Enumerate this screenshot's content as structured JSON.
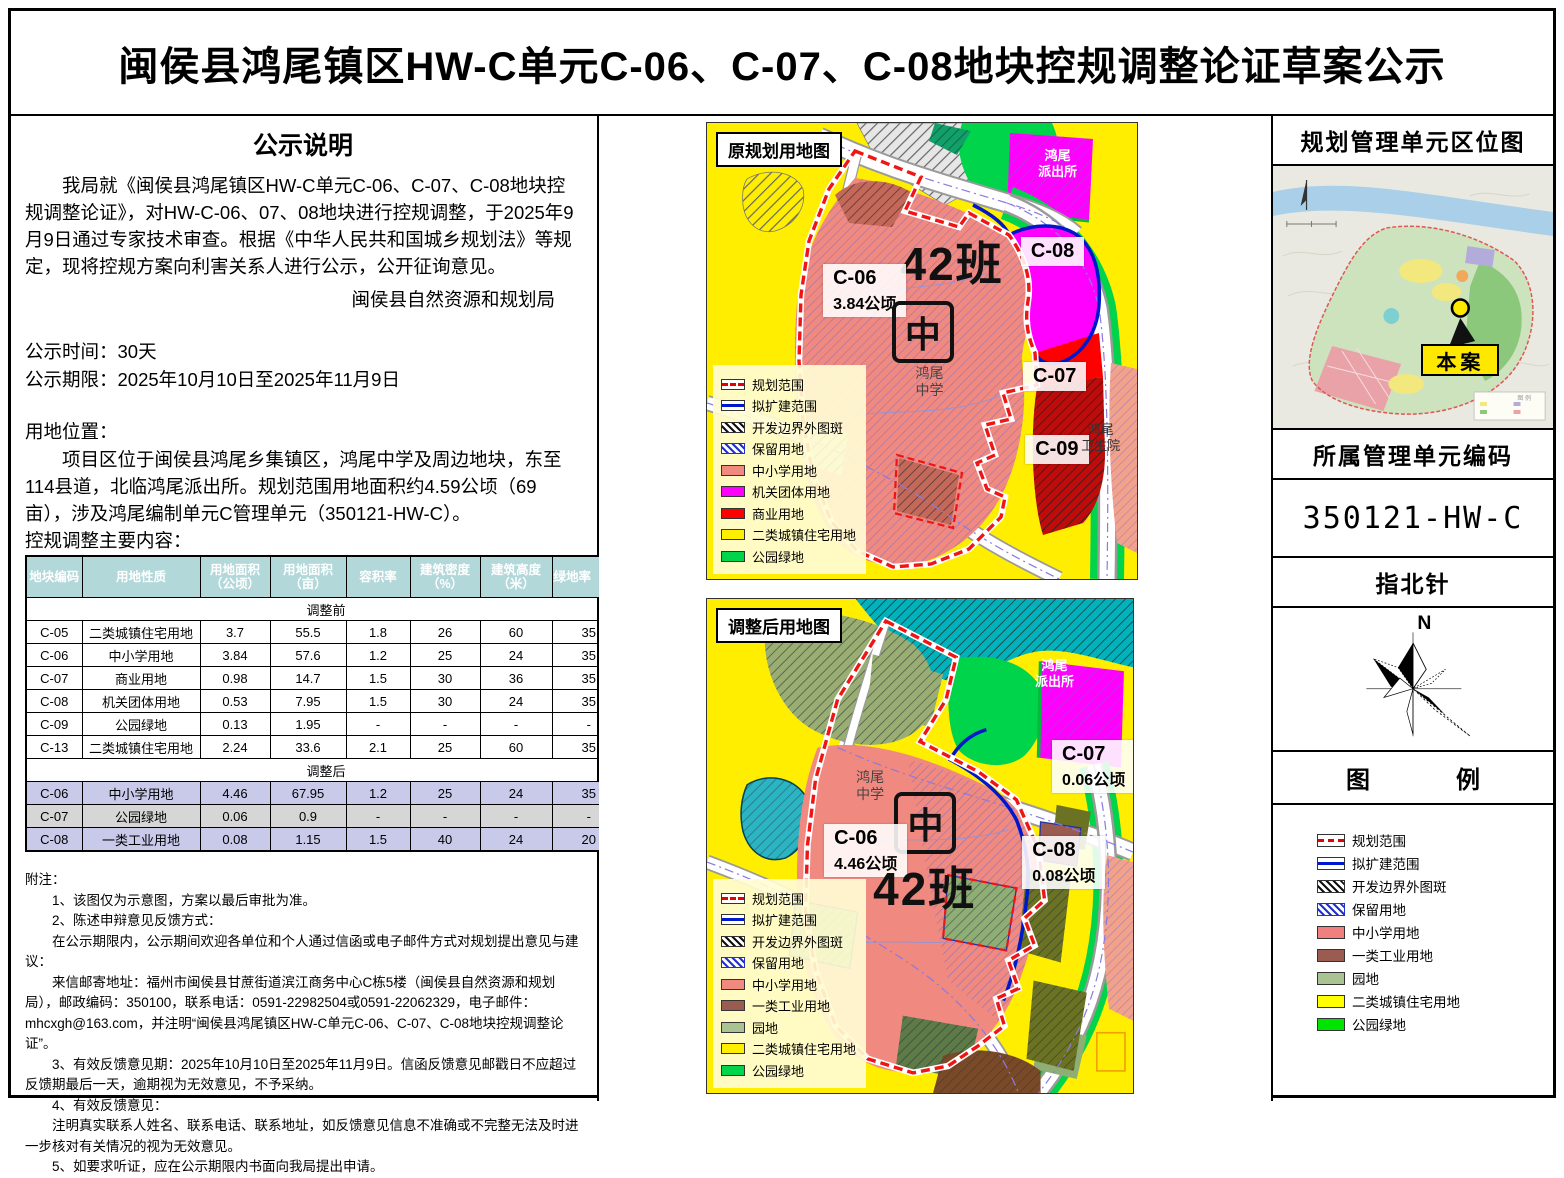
{
  "title": "闽侯县鸿尾镇区HW-C单元C-06、C-07、C-08地块控规调整论证草案公示",
  "left": {
    "announce_heading": "公示说明",
    "announce_body": "我局就《闽侯县鸿尾镇区HW-C单元C-06、C-07、C-08地块控规调整论证》，对HW-C-06、07、08地块进行控规调整，于2025年9月9日通过专家技术审查。根据《中华人民共和国城乡规划法》等规定，现将控规方案向利害关系人进行公示，公开征询意见。",
    "announce_signature": "闽侯县自然资源和规划局",
    "publicity_time": "公示时间：30天",
    "publicity_period": "公示期限：2025年10月10日至2025年11月9日",
    "location_heading": "用地位置：",
    "location_body": "项目区位于闽侯县鸿尾乡集镇区，鸿尾中学及周边地块，东至114县道，北临鸿尾派出所。规划范围用地面积约4.59公顷（69亩），涉及鸿尾编制单元C管理单元（350121-HW-C）。",
    "table_heading": "控规调整主要内容：",
    "notes": [
      "附注：",
      "1、该图仅为示意图，方案以最后审批为准。",
      "2、陈述申辩意见反馈方式：",
      "在公示期限内，公示期间欢迎各单位和个人通过信函或电子邮件方式对规划提出意见与建议：",
      "来信邮寄地址：福州市闽侯县甘蔗街道滨江商务中心C栋5楼（闽侯县自然资源和规划局），邮政编码：350100，联系电话：0591-22982504或0591-22062329，电子邮件：mhcxgh@163.com，并注明“闽侯县鸿尾镇区HW-C单元C-06、C-07、C-08地块控规调整论证”。",
      "3、有效反馈意见期：2025年10月10日至2025年11月9日。信函反馈意见邮戳日不应超过反馈期最后一天，逾期视为无效意见，不予采纳。",
      "4、有效反馈意见：",
      "注明真实联系人姓名、联系电话、联系地址，如反馈意见信息不准确或不完整无法及时进一步核对有关情况的视为无效意见。",
      "5、如要求听证，应在公示期限内书面向我局提出申请。"
    ]
  },
  "table": {
    "headers": [
      "地块编码",
      "用地性质",
      "用地面积\n（公顷）",
      "用地面积\n（亩）",
      "容积率",
      "建筑密度\n（%）",
      "建筑高度\n（米）",
      "绿地率（%）"
    ],
    "sections": [
      {
        "label": "调整前",
        "rows": [
          {
            "cells": [
              "C-05",
              "二类城镇住宅用地",
              "3.7",
              "55.5",
              "1.8",
              "26",
              "60",
              "35"
            ]
          },
          {
            "cells": [
              "C-06",
              "中小学用地",
              "3.84",
              "57.6",
              "1.2",
              "25",
              "24",
              "35"
            ]
          },
          {
            "cells": [
              "C-07",
              "商业用地",
              "0.98",
              "14.7",
              "1.5",
              "30",
              "36",
              "35"
            ]
          },
          {
            "cells": [
              "C-08",
              "机关团体用地",
              "0.53",
              "7.95",
              "1.5",
              "30",
              "24",
              "35"
            ]
          },
          {
            "cells": [
              "C-09",
              "公园绿地",
              "0.13",
              "1.95",
              "-",
              "-",
              "-",
              "-"
            ]
          },
          {
            "cells": [
              "C-13",
              "二类城镇住宅用地",
              "2.24",
              "33.6",
              "2.1",
              "25",
              "60",
              "35"
            ]
          }
        ]
      },
      {
        "label": "调整后",
        "rows": [
          {
            "cells": [
              "C-06",
              "中小学用地",
              "4.46",
              "67.95",
              "1.2",
              "25",
              "24",
              "35"
            ],
            "bg": "#c9c9ea"
          },
          {
            "cells": [
              "C-07",
              "公园绿地",
              "0.06",
              "0.9",
              "-",
              "-",
              "-",
              "-"
            ],
            "bg": "#d6d6d6"
          },
          {
            "cells": [
              "C-08",
              "一类工业用地",
              "0.08",
              "1.15",
              "1.5",
              "40",
              "24",
              "20"
            ],
            "bg": "#c9c9ea"
          }
        ]
      }
    ]
  },
  "map_before": {
    "title": "原规划用地图",
    "labels": {
      "police": "鸿尾\n派出所",
      "c08": "C-08",
      "c06_code": "C-06",
      "c06_area": "3.84公顷",
      "class_count": "42班",
      "school_mark": "中",
      "school_name": "鸿尾\n中学",
      "c07": "C-07",
      "c09": "C-09",
      "hospital": "鸿尾\n卫生院"
    },
    "legend": [
      {
        "type": "dash",
        "label": "规划范围"
      },
      {
        "type": "line",
        "label": "拟扩建范围"
      },
      {
        "type": "hatch-black",
        "label": "开发边界外图斑"
      },
      {
        "type": "hatch-blue",
        "label": "保留用地"
      },
      {
        "type": "fill",
        "color": "#f0897f",
        "label": "中小学用地"
      },
      {
        "type": "fill",
        "color": "#ff00ff",
        "label": "机关团体用地"
      },
      {
        "type": "fill",
        "color": "#ff0000",
        "label": "商业用地"
      },
      {
        "type": "fill",
        "color": "#ffee00",
        "label": "二类城镇住宅用地"
      },
      {
        "type": "fill",
        "color": "#00d44a",
        "label": "公园绿地"
      }
    ]
  },
  "map_after": {
    "title": "调整后用地图",
    "labels": {
      "police": "鸿尾\n派出所",
      "c07_code": "C-07",
      "c07_area": "0.06公顷",
      "school_name": "鸿尾\n中学",
      "school_mark": "中",
      "c06_code": "C-06",
      "c06_area": "4.46公顷",
      "class_count": "42班",
      "c08_code": "C-08",
      "c08_area": "0.08公顷"
    },
    "legend": [
      {
        "type": "dash",
        "label": "规划范围"
      },
      {
        "type": "line",
        "label": "拟扩建范围"
      },
      {
        "type": "hatch-black",
        "label": "开发边界外图斑"
      },
      {
        "type": "hatch-blue",
        "label": "保留用地"
      },
      {
        "type": "fill",
        "color": "#f0897f",
        "label": "中小学用地"
      },
      {
        "type": "fill",
        "color": "#9a5b50",
        "label": "一类工业用地"
      },
      {
        "type": "fill",
        "color": "#a9c492",
        "label": "园地"
      },
      {
        "type": "fill",
        "color": "#ffee00",
        "label": "二类城镇住宅用地"
      },
      {
        "type": "fill",
        "color": "#00d44a",
        "label": "公园绿地"
      }
    ]
  },
  "right_panel": {
    "location_title": "规划管理单元区位图",
    "case_label": "本案",
    "mini_legend_title": "图 例",
    "code_title": "所属管理单元编码",
    "code_value": "350121-HW-C",
    "compass_title": "指北针",
    "compass_north": "N",
    "legend_title_left": "图",
    "legend_title_right": "例",
    "legend": [
      {
        "type": "dash",
        "label": "规划范围"
      },
      {
        "type": "line",
        "label": "拟扩建范围"
      },
      {
        "type": "hatch-black",
        "label": "开发边界外图斑"
      },
      {
        "type": "hatch-blue",
        "label": "保留用地"
      },
      {
        "type": "fill",
        "color": "#f08080",
        "label": "中小学用地"
      },
      {
        "type": "fill",
        "color": "#9a5b50",
        "label": "一类工业用地"
      },
      {
        "type": "fill",
        "color": "#a9c492",
        "label": "园地"
      },
      {
        "type": "fill",
        "color": "#ffff00",
        "label": "二类城镇住宅用地"
      },
      {
        "type": "fill",
        "color": "#00e500",
        "label": "公园绿地"
      }
    ]
  },
  "colors": {
    "table_header": "#b2d8da",
    "row_adjusted": "#c9c9ea",
    "row_adjusted_gray": "#d6d6d6",
    "school_pink": "#f0897f",
    "government_magenta": "#ff00ff",
    "commercial_red": "#ff0000",
    "residential_yellow": "#ffee00",
    "park_green": "#00d44a",
    "industry_brown": "#9a5b50",
    "orchard_sage": "#a9c492",
    "plan_boundary_red": "#e60000",
    "expand_boundary_blue": "#0018cc"
  }
}
